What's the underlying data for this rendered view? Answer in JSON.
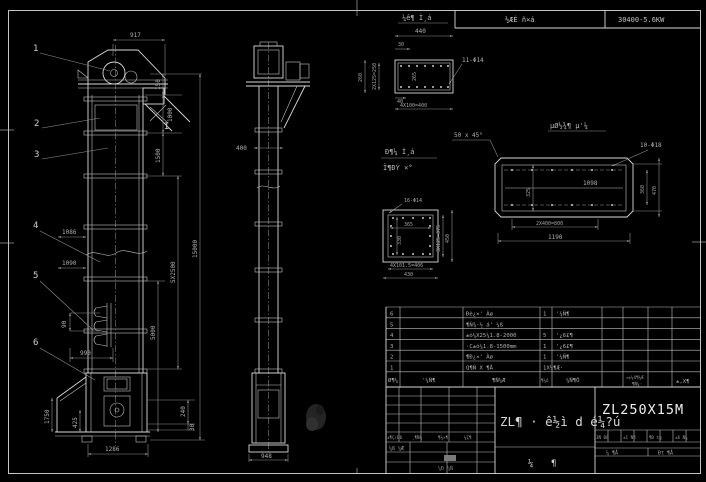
{
  "hdr": {
    "c1": "½ÆÈ ñ×á",
    "c2": "30400-5.6KW"
  },
  "fv": {
    "b1": "1",
    "b2": "2",
    "b3": "3",
    "b4": "4",
    "b5": "5",
    "b6": "6",
    "section": "I",
    "d917": "917",
    "d150": "150",
    "d1000": "1000",
    "d1500": "1500",
    "d15000": "15000",
    "d5x2500": "5X2500",
    "d5000": "5000",
    "d1086": "1086",
    "d1090": "1090",
    "d90": "90",
    "d990": "990",
    "d1750": "1750",
    "d425": "425",
    "d240": "240",
    "d30": "30",
    "d1286": "1286"
  },
  "sv": {
    "d400": "400",
    "d948": "948"
  },
  "da": {
    "title": "¼ê¶ Ì¸á",
    "holes": "11-Φ14",
    "d440": "440",
    "d30": "30",
    "inner": "265",
    "left1": "2X125=250",
    "left2": "260",
    "d40": "40",
    "pitch": "4X100=400"
  },
  "note45": "50 x 45°",
  "db": {
    "title": "µØ½¾¶ µ'¼",
    "holes": "10-Φ18",
    "d1098": "1098",
    "d325": "325",
    "d360": "360",
    "d470": "470",
    "pitch": "2X400=800",
    "d1190": "1190"
  },
  "dc": {
    "t1": "Ð¶¼ Ì¸á",
    "t2": "Ï¶ÐÝ ×°",
    "holes": "16-Φ14",
    "d365": "365",
    "d330": "330",
    "r1": "3X125=375",
    "r2": "450",
    "pitch": "4X101.5=406",
    "d430": "430"
  },
  "bom": {
    "rows": [
      {
        "no": "6",
        "name": "Ðè¿×' Àø",
        "qty": "1",
        "mat": "'¼Ñ¶"
      },
      {
        "no": "5",
        "name": "¶Ñ¾·½ á' ¼ß",
        "qty": "",
        "mat": ""
      },
      {
        "no": "4",
        "name": "±ó¼X25¼1.8-2000",
        "qty": "5",
        "mat": "'¿6£¶"
      },
      {
        "no": "3",
        "name": "·C±ó¼1.8-1500mm",
        "qty": "1",
        "mat": "'¿6£¶"
      },
      {
        "no": "2",
        "name": "¶Ð¿×' Àø",
        "qty": "1",
        "mat": "'¼Ñ¶"
      },
      {
        "no": "1",
        "name": "Q¶Ñ X ¶Å",
        "qty": "1X¼¶Æ·",
        "mat": ""
      }
    ],
    "h": {
      "no": "Ø¶¼",
      "dwg": "'¼Ñ¶",
      "name": "¶Ñ¼Æ",
      "qty": "¶¼ô",
      "mat": "¼Ñ¶Ô",
      "weight": "»±¼X¶¼Æ",
      "weight2": "¶Ñ¼·",
      "remark": "±,X¶"
    }
  },
  "tb": {
    "title": "ZL¶ · ê½ì d é¼?ú",
    "model": "ZL250X15M",
    "s1": "¼",
    "s2": "¶",
    "sig1": "±¶Ç(Ðß",
    "sig2": "¸¶Ñ¼",
    "sig3": "¶¼×¶",
    "sig4": "¼Ç¶",
    "design": "¼ß ¼Æ",
    "std": "¼Ð ¼Ñ",
    "c1": "3Ñ Ðß",
    "c2": "±1 Ñ¶",
    "c3": "¶Ð tg",
    "c4": "±ß Ñ¾",
    "no": "¼ ¶Å",
    "total": "Ðt ¶Å"
  }
}
